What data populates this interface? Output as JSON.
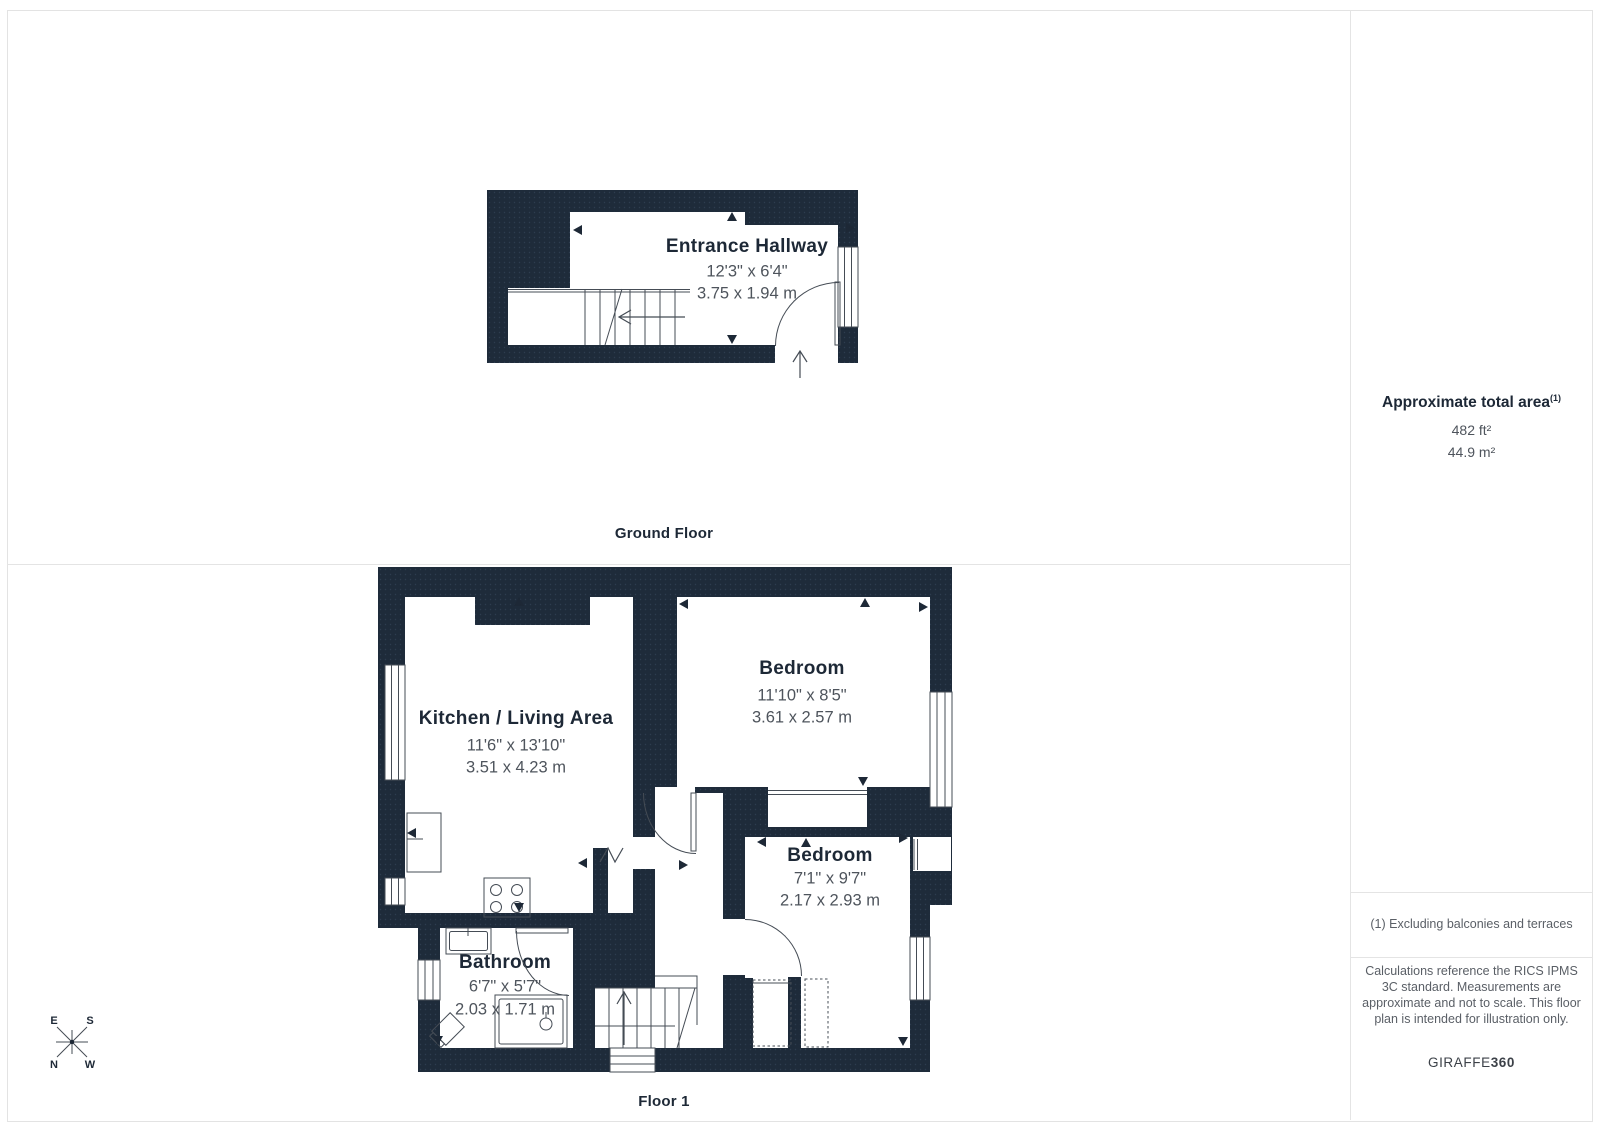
{
  "floors": [
    {
      "label": "Ground Floor",
      "rooms": [
        {
          "name": "Entrance Hallway",
          "dim_ft": "12'3\" x 6'4\"",
          "dim_m": "3.75 x 1.94 m"
        }
      ]
    },
    {
      "label": "Floor 1",
      "rooms": [
        {
          "name": "Kitchen / Living Area",
          "dim_ft": "11'6\" x 13'10\"",
          "dim_m": "3.51 x 4.23 m"
        },
        {
          "name": "Bedroom",
          "dim_ft": "11'10\" x 8'5\"",
          "dim_m": "3.61 x 2.57 m"
        },
        {
          "name": "Bedroom",
          "dim_ft": "7'1\" x 9'7\"",
          "dim_m": "2.17 x 2.93 m"
        },
        {
          "name": "Bathroom",
          "dim_ft": "6'7\" x 5'7\"",
          "dim_m": "2.03 x 1.71 m"
        }
      ]
    }
  ],
  "panel": {
    "total_area_label": "Approximate total area",
    "total_area_sup": "(1)",
    "area_ft": "482 ft²",
    "area_m": "44.9 m²",
    "footnote": "(1) Excluding balconies and terraces",
    "disclaimer": "Calculations reference the RICS IPMS 3C standard. Measurements are approximate and not to scale. This floor plan is intended for illustration only.",
    "brand_name": "GIRAFFE",
    "brand_suffix": "360"
  },
  "compass": {
    "e": "E",
    "s": "S",
    "n": "N",
    "w": "W"
  },
  "colors": {
    "wall": "#1e2b3a",
    "line": "#454c55",
    "label": "#1d2836",
    "dim": "#4e545c"
  }
}
